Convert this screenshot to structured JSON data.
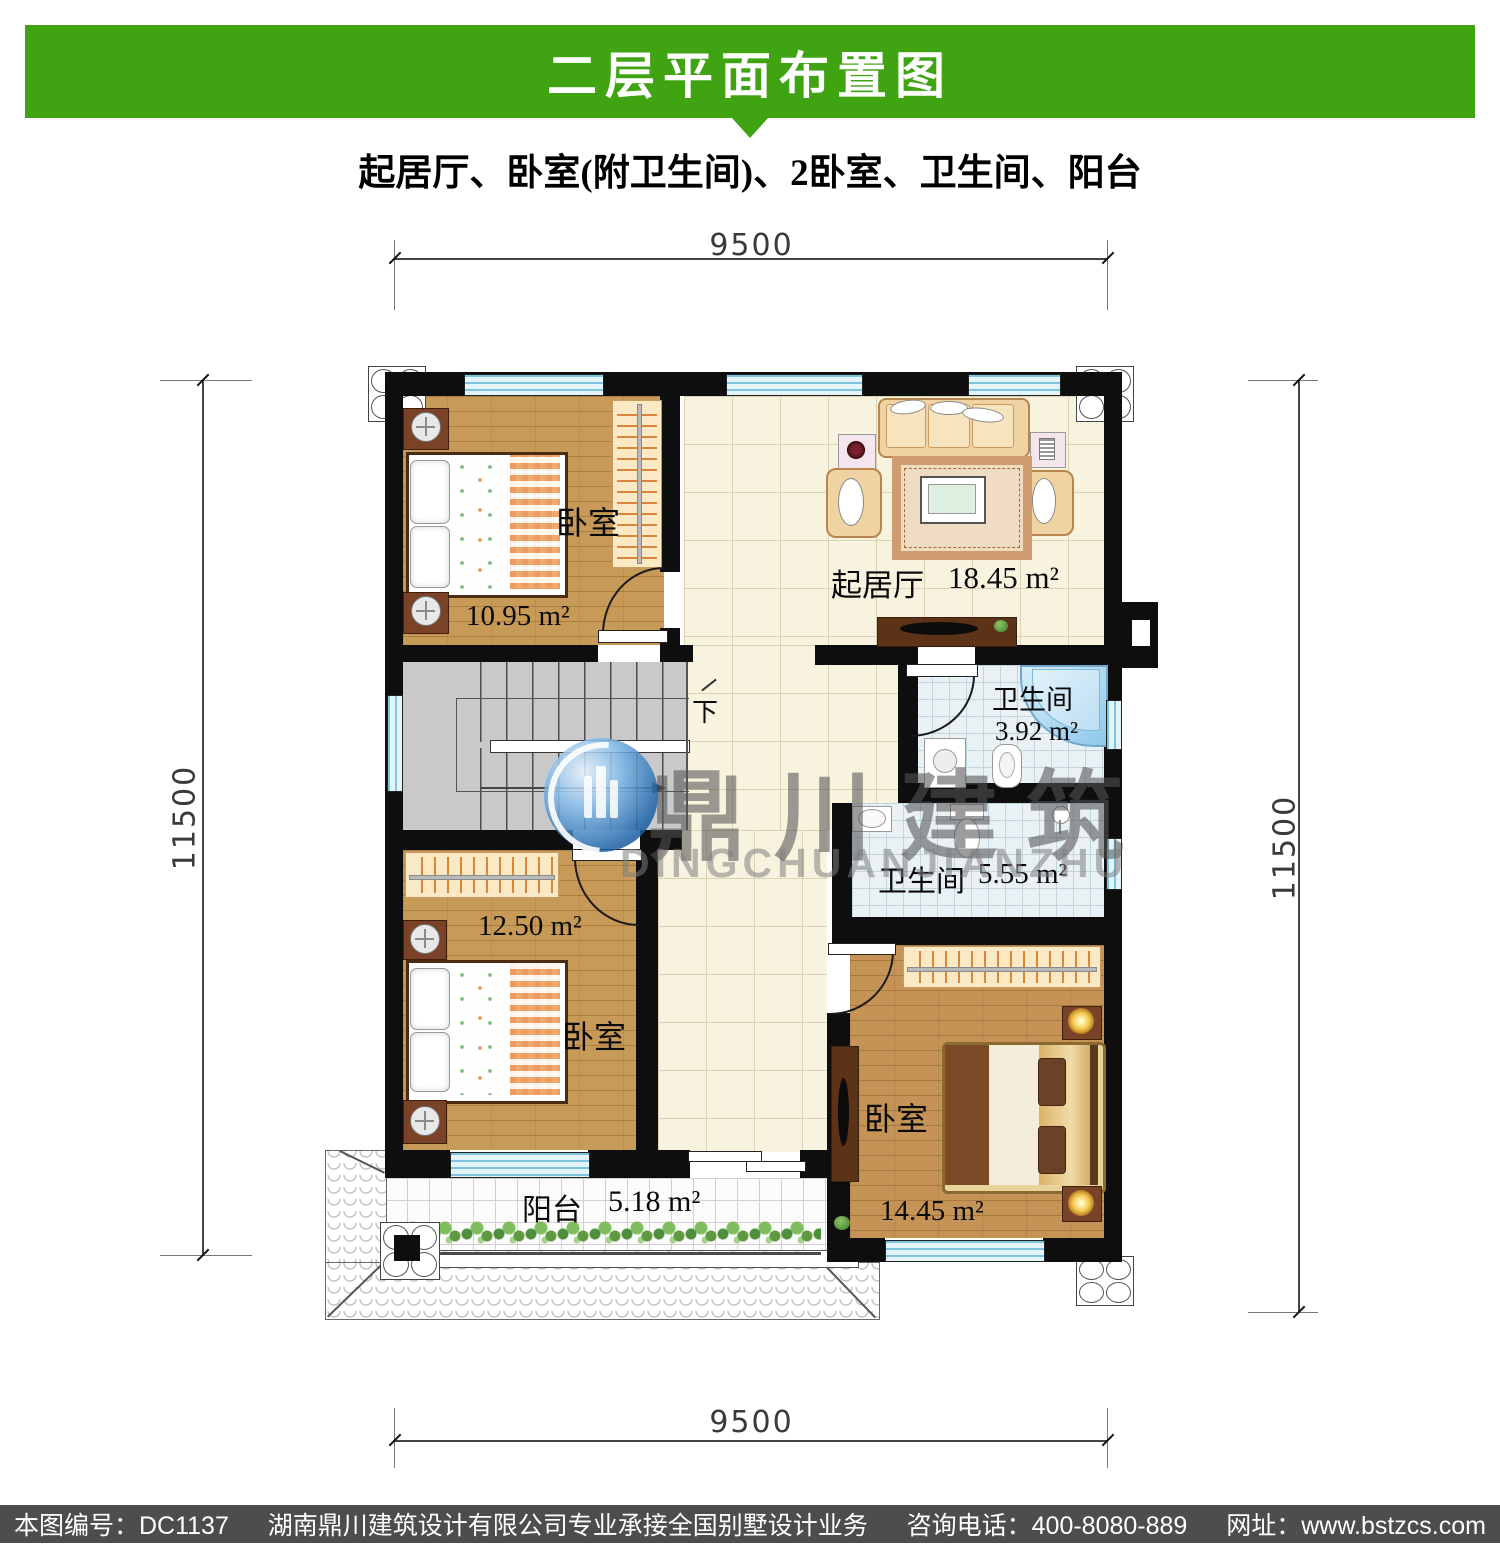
{
  "header": {
    "title": "二层平面布置图",
    "subtitle": "起居厅、卧室(附卫生间)、2卧室、卫生间、阳台",
    "bar_color": "#3FA312"
  },
  "dimensions": {
    "top": "9500",
    "bottom": "9500",
    "left": "11500",
    "right": "11500"
  },
  "rooms": {
    "bedroom_top_left": {
      "name": "卧室",
      "area": "10.95 m²"
    },
    "living_room": {
      "name": "起居厅",
      "area": "18.45 m²"
    },
    "bathroom_small": {
      "name": "卫生间",
      "area": "3.92 m²"
    },
    "bathroom_large": {
      "name": "卫生间",
      "area": "5.55 m²"
    },
    "bedroom_mid_left": {
      "name": "卧室",
      "area": "12.50 m²"
    },
    "bedroom_bottom_right": {
      "name": "卧室",
      "area": "14.45 m²"
    },
    "balcony": {
      "name": "阳台",
      "area": "5.18 m²"
    }
  },
  "stairs": {
    "down_label": "下"
  },
  "watermark": {
    "logo_cn": "鼎川建筑",
    "logo_en": "DINGCHUANJIANZHU"
  },
  "footer": {
    "drawing_no": "本图编号：DC1137",
    "company": "湖南鼎川建筑设计有限公司专业承接全国别墅设计业务",
    "phone": "咨询电话：400-8080-889",
    "website": "网址：www.bstzcs.com",
    "bar_color": "#4D4D4D"
  }
}
